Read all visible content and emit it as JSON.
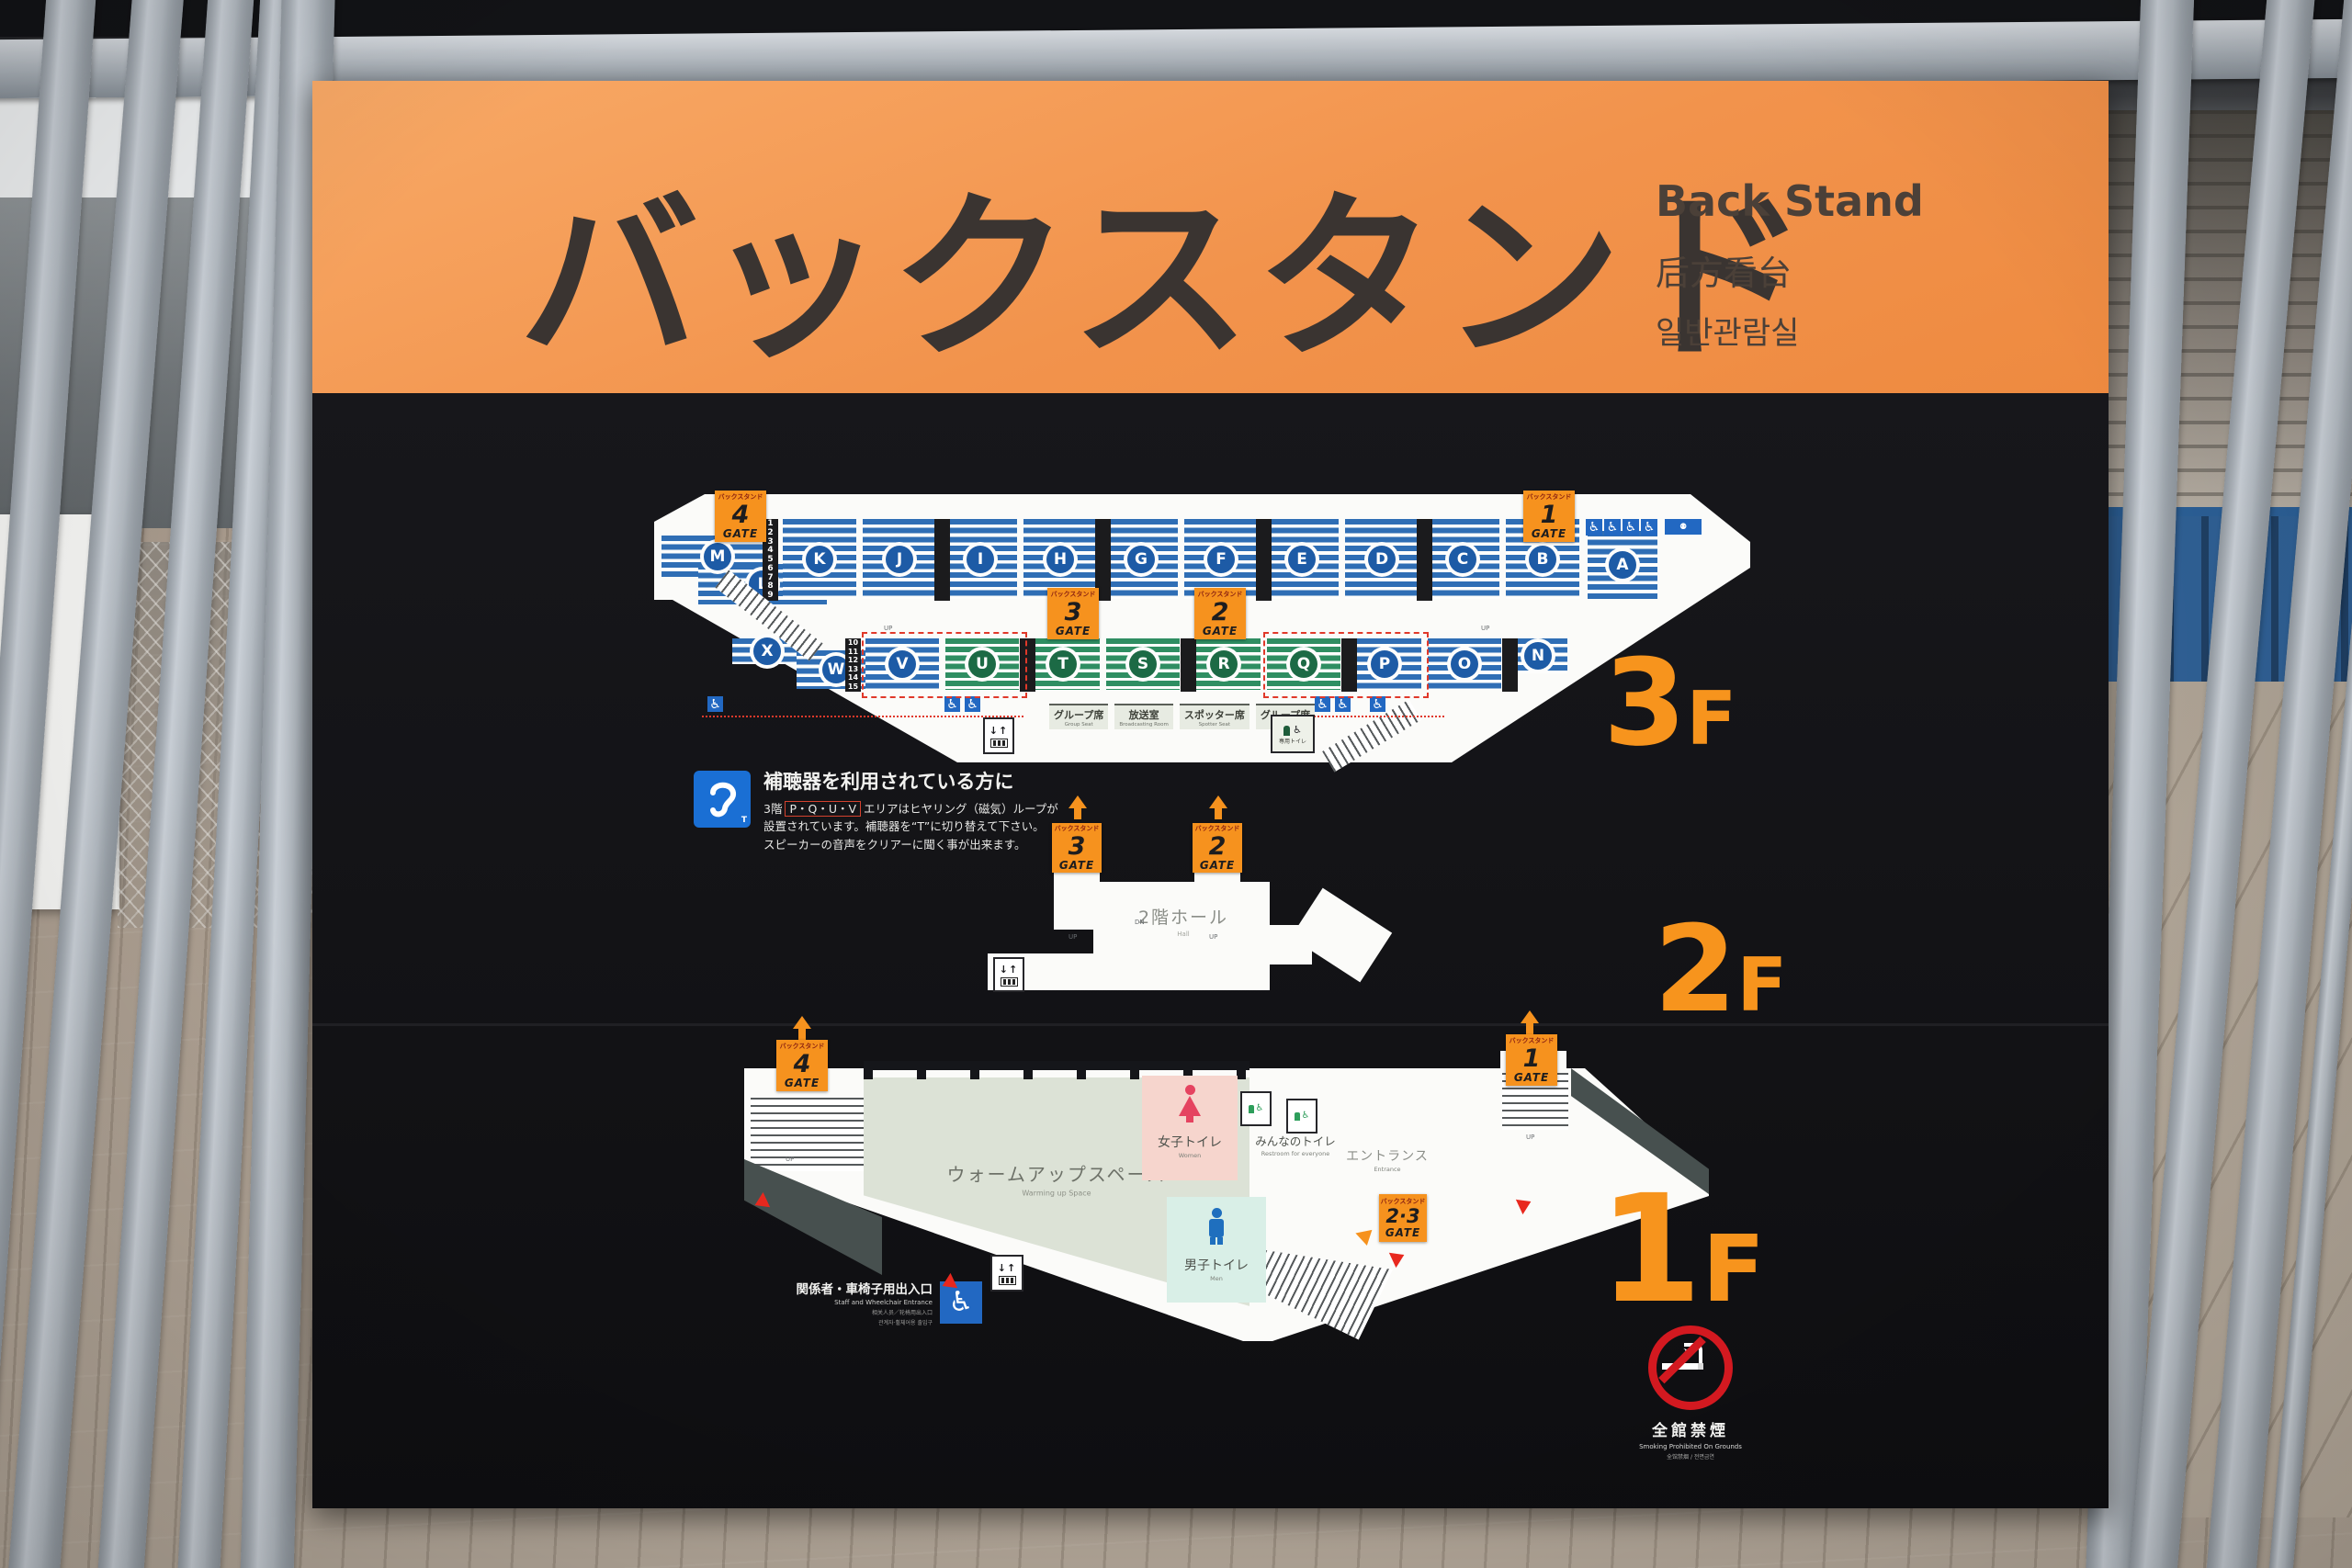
{
  "colors": {
    "header_orange": "#f2934c",
    "panel_black": "#141417",
    "gate_orange": "#f6921e",
    "floor_label_orange": "#f7941d",
    "seat_blue": "#2f6eb5",
    "seat_green": "#2f8e62",
    "badge_navy": "#1d5ba6",
    "badge_green": "#1c6a45",
    "women_pink": "#f6d5cd",
    "men_cyan": "#d9efe7",
    "warmup_sage": "#dce2d6",
    "wall_slate": "#47504f",
    "accessible_blue": "#2268c2",
    "alert_red": "#e0392a",
    "no_smoking_red": "#d31920"
  },
  "header": {
    "title_ja": "バックスタンド",
    "title_en": "Back Stand",
    "title_zh": "后方看台",
    "title_ko": "일반관람실"
  },
  "gate": {
    "stand": "バックスタンド",
    "word": "GATE"
  },
  "floor3": {
    "label_digit": "3",
    "label_suffix": "F",
    "gates": {
      "top_left": "4",
      "top_right": "1",
      "mid_left": "3",
      "mid_right": "2"
    },
    "sections_upper": [
      "M",
      "L",
      "K",
      "J",
      "I",
      "H",
      "G",
      "F",
      "E",
      "D",
      "C",
      "B",
      "A"
    ],
    "sections_lower": [
      "X",
      "W",
      "V",
      "U",
      "T",
      "S",
      "R",
      "Q",
      "P",
      "O",
      "N"
    ],
    "rows_upper": [
      "1",
      "2",
      "3",
      "4",
      "5",
      "6",
      "7",
      "8",
      "9"
    ],
    "rows_lower": [
      "10",
      "11",
      "12",
      "13",
      "14",
      "15"
    ],
    "facilities": [
      {
        "ja": "グループ席",
        "en": "Group Seat"
      },
      {
        "ja": "放送室",
        "en": "Broadcasting Room"
      },
      {
        "ja": "スポッター席",
        "en": "Spotter Seat"
      },
      {
        "ja": "グループ席",
        "en": "Group Seat"
      }
    ],
    "private_toilet": "専用トイレ"
  },
  "hearing": {
    "title": "補聴器を利用されている方に",
    "line1_pre": "3階",
    "areas": "P・Q・U・V",
    "line1_post": "エリアはヒヤリング（磁気）ループが",
    "line2": "設置されています。補聴器を“T”に切り替えて下さい。",
    "line3": "スピーカーの音声をクリアーに聞く事が出来ます。",
    "icon_label": "T"
  },
  "floor2": {
    "label_digit": "2",
    "label_suffix": "F",
    "gates": {
      "left": "3",
      "right": "2"
    },
    "hall_ja": "2階ホール",
    "hall_en": "Hall"
  },
  "floor1": {
    "label_digit": "1",
    "label_suffix": "F",
    "gates": {
      "left": "4",
      "right": "1",
      "mid": "2·3"
    },
    "warmup_ja": "ウォームアップスペース",
    "warmup_en": "Warming up Space",
    "women_ja": "女子トイレ",
    "women_en": "Women",
    "men_ja": "男子トイレ",
    "men_en": "Men",
    "everyone_ja": "みんなのトイレ",
    "everyone_en": "Restroom for everyone",
    "entrance_ja": "エントランス",
    "entrance_en": "Entrance",
    "staff_ja": "関係者・車椅子用出入口",
    "staff_en": "Staff and Wheelchair Entrance",
    "staff_zh": "相关人员／轮椅用出入口",
    "staff_ko": "관계자·휠체어용 출입구"
  },
  "no_smoking": {
    "ja": "全館禁煙",
    "en": "Smoking Prohibited On Grounds",
    "sub": "全馆禁烟 / 전면금연"
  },
  "icons": {
    "wheelchair": "♿",
    "elevator": "↓↑",
    "stair_up": "UP",
    "stair_dn": "DN"
  }
}
